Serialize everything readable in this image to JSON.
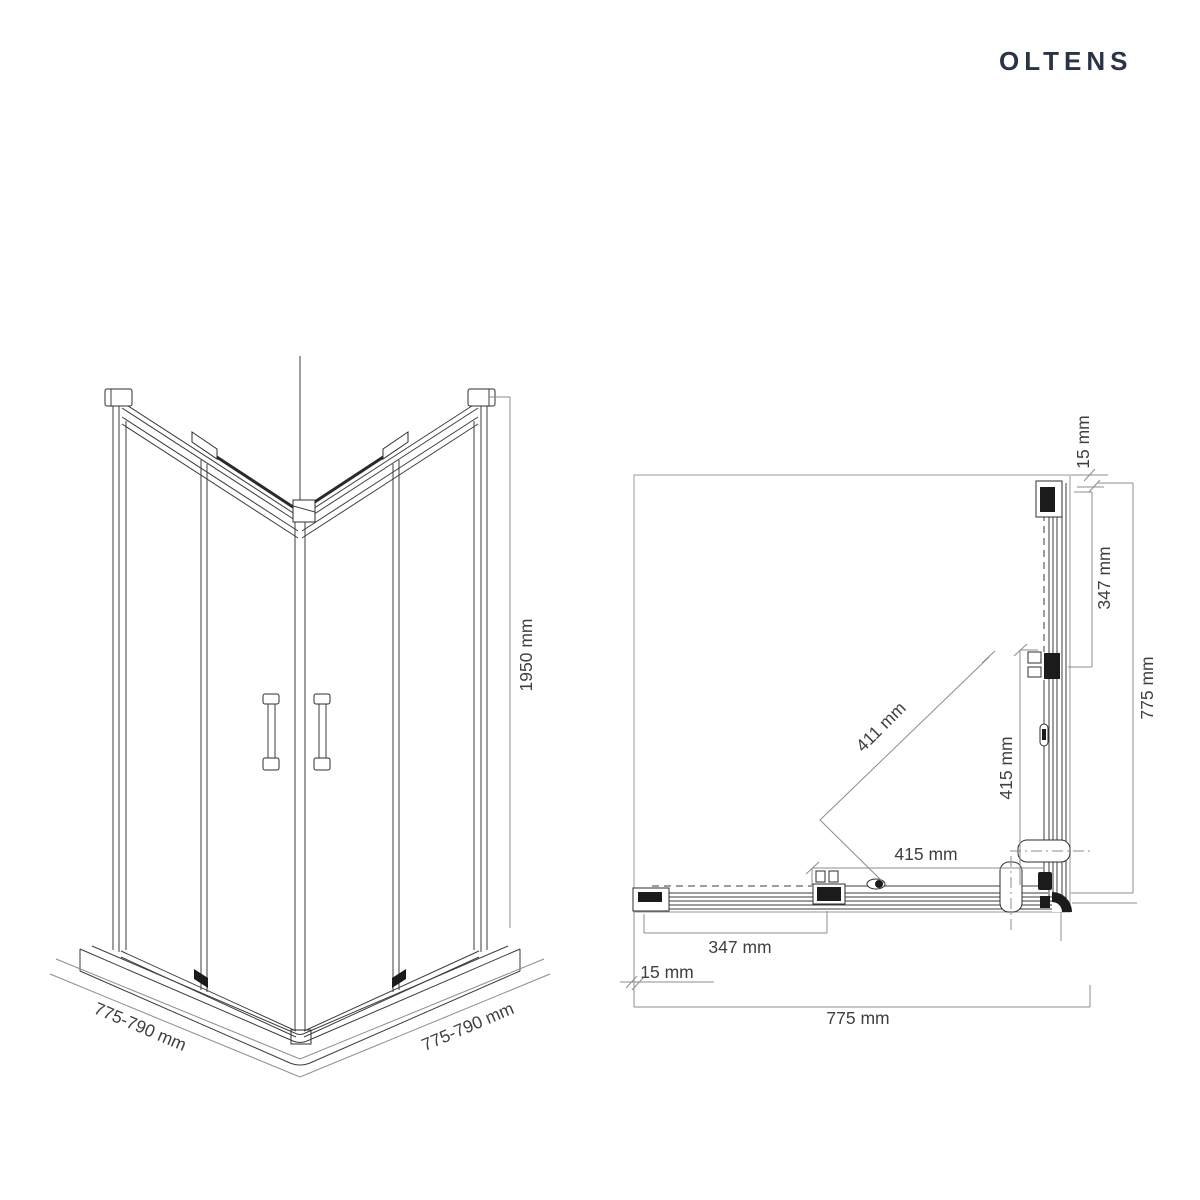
{
  "brand": {
    "name": "OLTENS",
    "color": "#2A3447"
  },
  "front_view": {
    "height": "1950 mm",
    "base_width_left": "775-790 mm",
    "base_width_right": "775-790 mm"
  },
  "plan_view": {
    "wall_offset_top": "15 mm",
    "fixed_panel_right": "347 mm",
    "overall_right": "775 mm",
    "door_diagonal": "411 mm",
    "door_width_vertical": "415 mm",
    "door_width_horizontal": "415 mm",
    "fixed_panel_bottom": "347 mm",
    "wall_offset_bottom": "15 mm",
    "overall_bottom": "775 mm"
  },
  "colors": {
    "line_dark": "#3d3d3d",
    "line_light": "#8c8c8c",
    "hardware": "#1b1b1b",
    "background": "#ffffff"
  }
}
